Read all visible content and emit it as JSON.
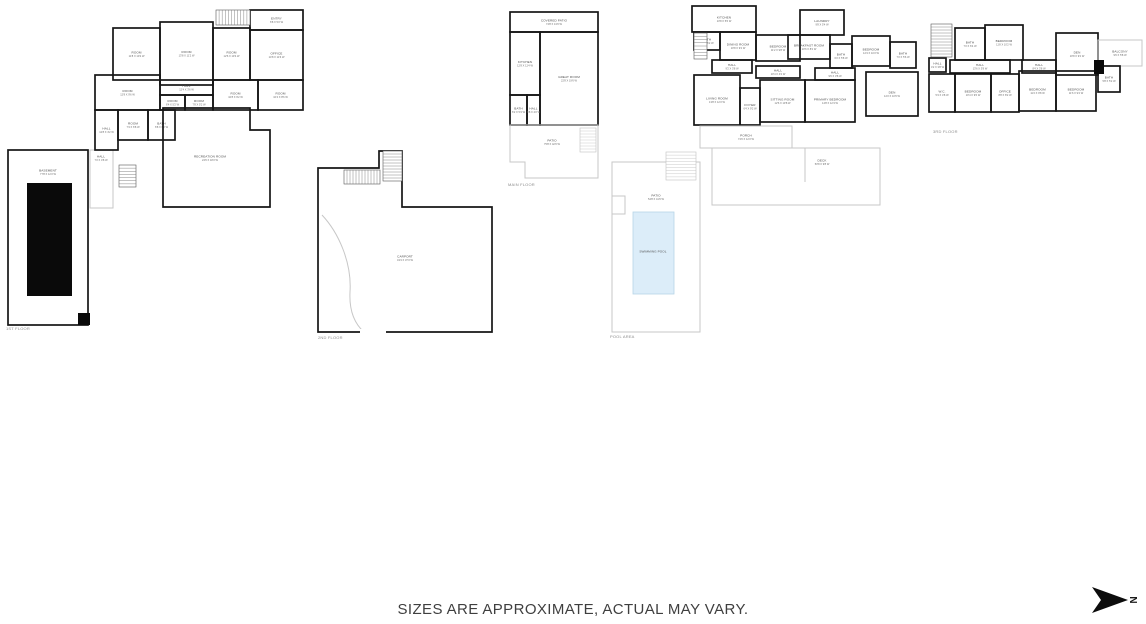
{
  "footer": {
    "disclaimer": "SIZES ARE APPROXIMATE, ACTUAL MAY VARY."
  },
  "compass": {
    "label": "N"
  },
  "colors": {
    "wall": "#161616",
    "light_wall": "#c7c7c7",
    "pool_fill": "#dcedf9",
    "pool_border": "#b7d4e6",
    "label_text": "#4d4d4d",
    "footer_text": "#3f3f3f",
    "background": "#ffffff"
  },
  "plans": [
    {
      "id": "first-floor",
      "floor_label": {
        "text": "1ST FLOOR",
        "x": 6,
        "y": 330
      },
      "rooms": [
        {
          "name": "ENTRY",
          "dims": "6'8 X 5'2 W",
          "x": 250,
          "y": 10,
          "w": 53,
          "h": 20
        },
        {
          "name": "ROOM",
          "dims": "11'8 X 10'2 W",
          "x": 113,
          "y": 28,
          "w": 47,
          "h": 52
        },
        {
          "name": "ROOM",
          "dims": "13'8 X 11'2 W",
          "x": 160,
          "y": 22,
          "w": 53,
          "h": 63
        },
        {
          "name": "ROOM",
          "dims": "12'6 X 10'4 W",
          "x": 213,
          "y": 28,
          "w": 37,
          "h": 52
        },
        {
          "name": "OFFICE",
          "dims": "14'8 X 11'6 W",
          "x": 250,
          "y": 30,
          "w": 53,
          "h": 50
        },
        {
          "name": "ROOM",
          "dims": "10'4 X 8'6 W",
          "x": 258,
          "y": 80,
          "w": 45,
          "h": 30
        },
        {
          "name": "ROOM",
          "dims": "10'8 X 9'2 W",
          "x": 213,
          "y": 80,
          "w": 45,
          "h": 30
        },
        {
          "name": "HALL",
          "dims": "12'4 X 3'6 W",
          "x": 160,
          "y": 80,
          "w": 53,
          "h": 15
        },
        {
          "name": "ROOM",
          "dims": "12'8 X 9'6 W",
          "x": 95,
          "y": 75,
          "w": 65,
          "h": 35
        },
        {
          "name": "ROOM",
          "dims": "6'4 X 5'2 W",
          "x": 160,
          "y": 95,
          "w": 25,
          "h": 15
        },
        {
          "name": "ROOM",
          "dims": "7'8 X 5'2 W",
          "x": 185,
          "y": 95,
          "w": 28,
          "h": 15
        },
        {
          "name": "ROOM",
          "dims": "7'4 X 6'8 W",
          "x": 118,
          "y": 110,
          "w": 30,
          "h": 30
        },
        {
          "name": "BATH",
          "dims": "6'8 X 6'2 W",
          "x": 148,
          "y": 110,
          "w": 27,
          "h": 30
        },
        {
          "name": "HALL",
          "dims": "7'2 X 4'8 W",
          "x": 90,
          "y": 150,
          "w": 23,
          "h": 58,
          "style": "light",
          "lx": 101,
          "ly": 158
        },
        {
          "name": "HALL",
          "dims": "12'8 X 4'2 W",
          "x": 95,
          "y": 110,
          "w": 23,
          "h": 40
        },
        {
          "name": "BASEMENT",
          "dims": "77'8 X 12'2 W",
          "x": 8,
          "y": 150,
          "w": 80,
          "h": 175,
          "lx": 48,
          "ly": 172
        },
        {
          "name": "RECREATION ROOM",
          "dims": "24'6 X 18'2 W",
          "poly": "M163,108 H250 V130 H270 V207 H163 Z",
          "lx": 210,
          "ly": 158
        }
      ],
      "fills": [
        {
          "name": "solid-black-area",
          "x": 27,
          "y": 183,
          "w": 45,
          "h": 113,
          "color": "#0a0a0a"
        },
        {
          "name": "solid-black-step",
          "x": 78,
          "y": 313,
          "w": 12,
          "h": 12,
          "color": "#0a0a0a"
        }
      ],
      "stairs": [
        {
          "x": 216,
          "y": 10,
          "w": 34,
          "h": 15,
          "dir": "h"
        },
        {
          "x": 119,
          "y": 165,
          "w": 17,
          "h": 22,
          "dir": "v"
        }
      ]
    },
    {
      "id": "second-floor",
      "floor_label": {
        "text": "2ND FLOOR",
        "x": 318,
        "y": 339
      },
      "rooms": [
        {
          "name": "CARPORT",
          "dims": "43'4 X 37'2 W",
          "poly": "M318,168 V332 H492 V207 H402 V151 H379 V168 Z",
          "lx": 405,
          "ly": 258
        }
      ],
      "walls": [
        {
          "path": "M322,215 C338,232 352,262 350,292 C349,312 355,324 364,332",
          "style": "light"
        }
      ],
      "fills": [
        {
          "name": "door-opening",
          "x": 360,
          "y": 329,
          "w": 26,
          "h": 6,
          "color": "#ffffff"
        }
      ],
      "stairs": [
        {
          "x": 344,
          "y": 170,
          "w": 36,
          "h": 14,
          "dir": "h"
        },
        {
          "x": 383,
          "y": 151,
          "w": 19,
          "h": 30,
          "dir": "v"
        }
      ]
    },
    {
      "id": "main-floor",
      "floor_label": {
        "text": "MAIN FLOOR",
        "x": 508,
        "y": 186
      },
      "rooms": [
        {
          "name": "COVERED PATIO",
          "dims": "74'8 X 13'0 W",
          "x": 510,
          "y": 12,
          "w": 88,
          "h": 20
        },
        {
          "name": "KITCHEN",
          "dims": "12'8 X 11'4 W",
          "x": 510,
          "y": 32,
          "w": 30,
          "h": 63
        },
        {
          "name": "GREAT ROOM",
          "dims": "22'8 X 19'6 W",
          "x": 540,
          "y": 32,
          "w": 58,
          "h": 93
        },
        {
          "name": "BATH",
          "dims": "6'2 X 5'4 W",
          "x": 510,
          "y": 95,
          "w": 17,
          "h": 30
        },
        {
          "name": "HALL",
          "dims": "6'8 X 4'2 W",
          "x": 527,
          "y": 95,
          "w": 13,
          "h": 30
        },
        {
          "name": "PATIO",
          "dims": "75'8 X 42'0 W",
          "poly": "M510,125 H598 V178 H525 V162 H510 Z",
          "style": "light",
          "lx": 552,
          "ly": 142
        }
      ],
      "stairs": [
        {
          "x": 580,
          "y": 128,
          "w": 16,
          "h": 24,
          "dir": "v",
          "style": "light"
        }
      ]
    },
    {
      "id": "pool-area",
      "floor_label": {
        "text": "POOL AREA",
        "x": 610,
        "y": 338
      },
      "rooms": [
        {
          "name": "PATIO",
          "dims": "54'8 X 41'6 W",
          "poly": "M612,162 H700 V332 H612 Z",
          "style": "light",
          "lx": 656,
          "ly": 197
        },
        {
          "name": "DECK",
          "dims": "53'8 X 9'8 W",
          "x": 712,
          "y": 148,
          "w": 168,
          "h": 57,
          "style": "light",
          "lx": 822,
          "ly": 162
        },
        {
          "name": "SWIMMING POOL",
          "dims": "",
          "x": 633,
          "y": 212,
          "w": 41,
          "h": 82,
          "style": "pool",
          "fill": "#dcedf9",
          "lx": 653,
          "ly": 253
        }
      ],
      "walls": [
        {
          "path": "M612,196 h13 v18 h-13 Z",
          "style": "light"
        },
        {
          "path": "M805,148 V182",
          "style": "light"
        }
      ],
      "stairs": [
        {
          "x": 666,
          "y": 152,
          "w": 30,
          "h": 28,
          "dir": "v",
          "style": "light"
        }
      ]
    },
    {
      "id": "upper-floor",
      "rooms": [
        {
          "name": "KITCHEN",
          "dims": "13'8 X 5'6 W",
          "x": 692,
          "y": 6,
          "w": 64,
          "h": 26
        },
        {
          "name": "BATH",
          "dims": "5'8 X 5'2 W",
          "x": 694,
          "y": 32,
          "w": 26,
          "h": 18
        },
        {
          "name": "DINING ROOM",
          "dims": "10'8 X 9'2 W",
          "x": 720,
          "y": 32,
          "w": 36,
          "h": 28
        },
        {
          "name": "BEDROOM",
          "dims": "11'2 X 9'8 W",
          "x": 756,
          "y": 35,
          "w": 44,
          "h": 26
        },
        {
          "name": "LAUNDRY",
          "dims": "9'8 X 5'4 W",
          "x": 800,
          "y": 10,
          "w": 44,
          "h": 25
        },
        {
          "name": "BREAKFAST ROOM",
          "dims": "10'6 X 8'2 W",
          "x": 788,
          "y": 35,
          "w": 42,
          "h": 24
        },
        {
          "name": "BATH",
          "dims": "6'2 X 5'8 W",
          "x": 830,
          "y": 44,
          "w": 22,
          "h": 24
        },
        {
          "name": "BEDROOM",
          "dims": "12'4 X 10'2 W",
          "x": 852,
          "y": 36,
          "w": 38,
          "h": 30
        },
        {
          "name": "BATH",
          "dims": "7'2 X 5'6 W",
          "x": 890,
          "y": 42,
          "w": 26,
          "h": 26
        },
        {
          "name": "HALL",
          "dims": "9'2 X 3'8 W",
          "x": 712,
          "y": 60,
          "w": 40,
          "h": 13
        },
        {
          "name": "HALL",
          "dims": "10'4 X 4'2 W",
          "x": 756,
          "y": 66,
          "w": 44,
          "h": 12
        },
        {
          "name": "HALL",
          "dims": "9'6 X 3'8 W",
          "x": 815,
          "y": 68,
          "w": 40,
          "h": 12
        },
        {
          "name": "LIVING ROOM",
          "dims": "13'8 X 12'2 W",
          "x": 694,
          "y": 75,
          "w": 46,
          "h": 50
        },
        {
          "name": "FOYER",
          "dims": "6'4 X 9'2 W",
          "x": 740,
          "y": 88,
          "w": 20,
          "h": 37
        },
        {
          "name": "SITTING ROOM",
          "dims": "12'6 X 10'8 W",
          "x": 760,
          "y": 80,
          "w": 45,
          "h": 42
        },
        {
          "name": "PRIMARY BEDROOM",
          "dims": "14'8 X 12'4 W",
          "x": 805,
          "y": 80,
          "w": 50,
          "h": 42
        },
        {
          "name": "DEN",
          "dims": "12'2 X 10'6 W",
          "x": 866,
          "y": 72,
          "w": 52,
          "h": 44
        },
        {
          "name": "PORCH",
          "dims": "74'0 X 12'2 W",
          "x": 700,
          "y": 126,
          "w": 92,
          "h": 22,
          "style": "light"
        }
      ],
      "stairs": [
        {
          "x": 694,
          "y": 33,
          "w": 13,
          "h": 26,
          "dir": "v"
        }
      ]
    },
    {
      "id": "third-floor",
      "floor_label": {
        "text": "3RD FLOOR",
        "x": 933,
        "y": 133
      },
      "rooms": [
        {
          "name": "BATH",
          "dims": "7'2 X 6'4 W",
          "x": 955,
          "y": 28,
          "w": 30,
          "h": 32
        },
        {
          "name": "BEDROOM",
          "dims": "11'8 X 10'2 W",
          "x": 985,
          "y": 25,
          "w": 38,
          "h": 35
        },
        {
          "name": "HALL",
          "dims": "4'2 X 3'8 W",
          "x": 929,
          "y": 58,
          "w": 17,
          "h": 14
        },
        {
          "name": "HALL",
          "dims": "13'6 X 3'8 W",
          "x": 950,
          "y": 60,
          "w": 60,
          "h": 13
        },
        {
          "name": "HALL",
          "dims": "8'4 X 3'8 W",
          "x": 1022,
          "y": 60,
          "w": 34,
          "h": 13
        },
        {
          "name": "DEN",
          "dims": "10'8 X 9'2 W",
          "x": 1056,
          "y": 33,
          "w": 42,
          "h": 42
        },
        {
          "name": "BALCONY",
          "dims": "9'6 X 5'8 W",
          "x": 1098,
          "y": 40,
          "w": 44,
          "h": 26,
          "style": "light"
        },
        {
          "name": "BATH",
          "dims": "5'8 X 5'2 W",
          "x": 1098,
          "y": 66,
          "w": 22,
          "h": 26
        },
        {
          "name": "W.C.",
          "dims": "5'4 X 4'8 W",
          "x": 929,
          "y": 74,
          "w": 26,
          "h": 38
        },
        {
          "name": "BEDROOM",
          "dims": "10'4 X 9'6 W",
          "x": 955,
          "y": 74,
          "w": 36,
          "h": 38
        },
        {
          "name": "OFFICE",
          "dims": "8'8 X 8'2 W",
          "x": 991,
          "y": 74,
          "w": 28,
          "h": 38
        },
        {
          "name": "BEDROOM",
          "dims": "11'2 X 9'8 W",
          "x": 1019,
          "y": 71,
          "w": 37,
          "h": 40
        },
        {
          "name": "BEDROOM",
          "dims": "11'6 X 9'4 W",
          "x": 1056,
          "y": 71,
          "w": 40,
          "h": 40
        }
      ],
      "fills": [
        {
          "name": "solid-black-wall",
          "x": 1094,
          "y": 60,
          "w": 10,
          "h": 14,
          "color": "#0a0a0a"
        }
      ],
      "stairs": [
        {
          "x": 931,
          "y": 24,
          "w": 21,
          "h": 33,
          "dir": "v"
        }
      ]
    }
  ]
}
